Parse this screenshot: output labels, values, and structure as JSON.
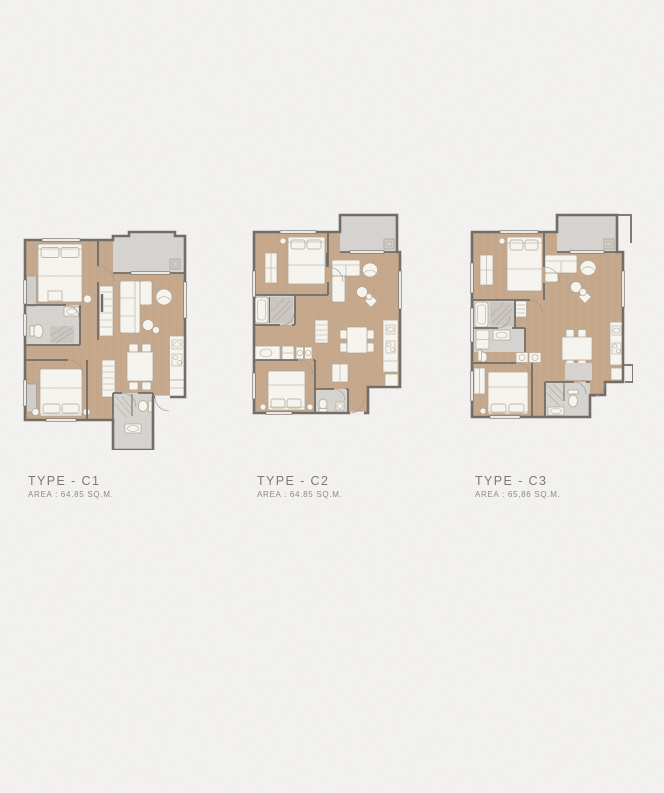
{
  "theme": {
    "paper": "#f5f4f2",
    "wall": "#6f6a64",
    "floor_wood": "#c7a98b",
    "floor_wood_dark": "#a98d70",
    "floor_gray": "#d7d5d1",
    "floor_gray_dark": "#cbc8c3",
    "furniture_fill": "#f9f7f2",
    "furniture_stroke": "#b0a492",
    "window_fill": "#efedea",
    "label_color": "#7b7772",
    "sublabel_color": "#8c8984"
  },
  "plans": [
    {
      "id": "c1",
      "type_label": "TYPE - C1",
      "area_label": "AREA : 64.85 SQ.M."
    },
    {
      "id": "c2",
      "type_label": "TYPE - C2",
      "area_label": "AREA : 64.85 SQ.M."
    },
    {
      "id": "c3",
      "type_label": "TYPE - C3",
      "area_label": "AREA : 65,86 SQ.M."
    }
  ]
}
